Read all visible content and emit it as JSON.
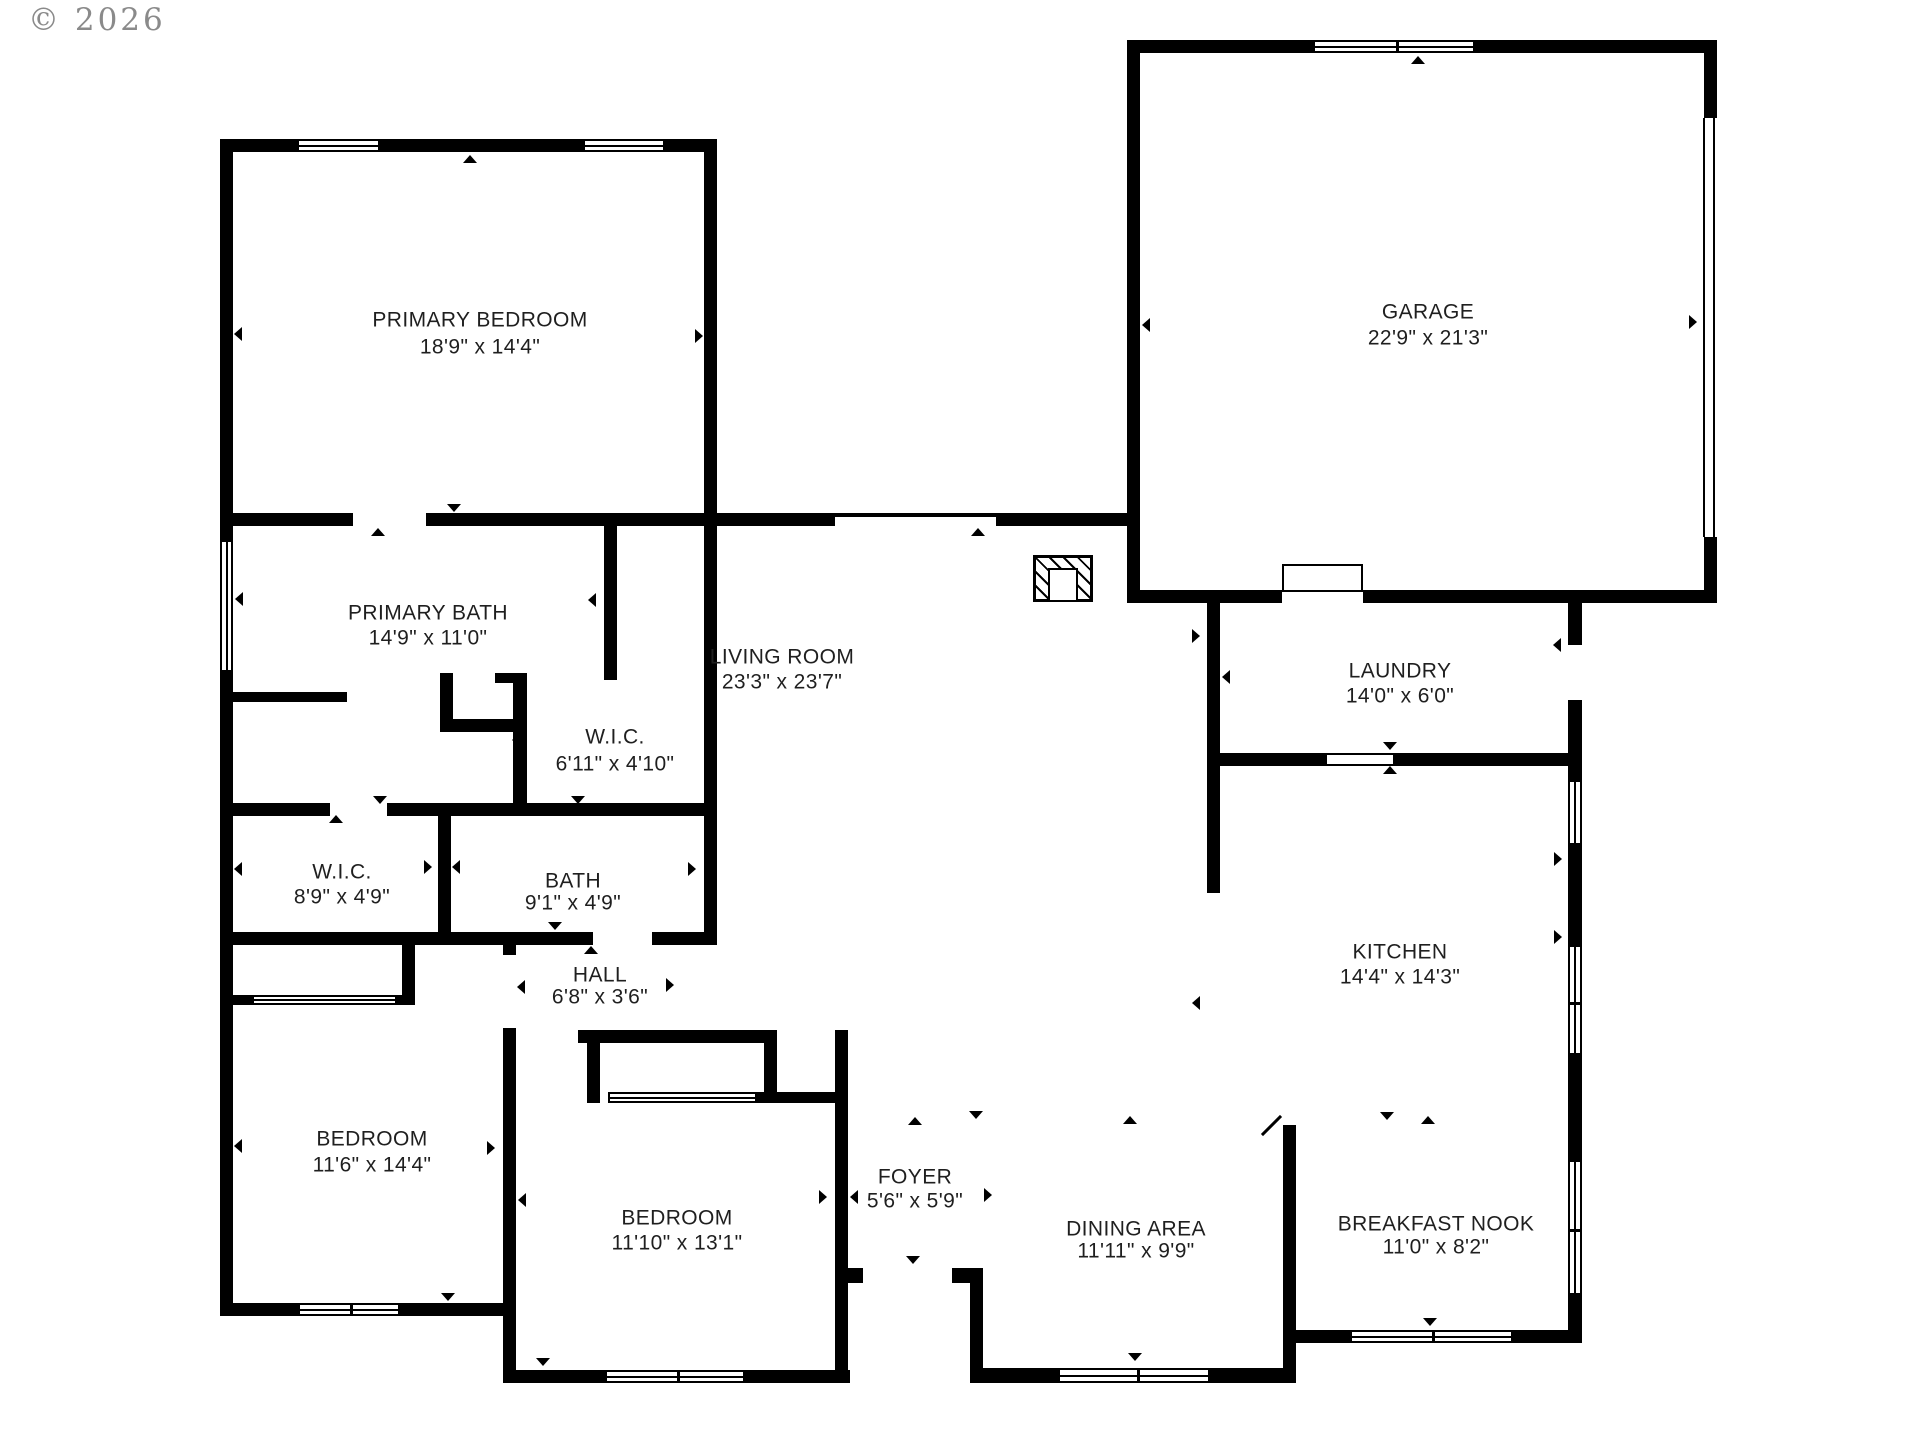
{
  "watermark": {
    "text": "© 2026"
  },
  "canvas": {
    "width": 1920,
    "height": 1440,
    "background": "#ffffff",
    "wall_color": "#000000",
    "label_color": "#1f1f1f",
    "watermark_color": "#8a8a8a"
  },
  "rooms": [
    {
      "name": "PRIMARY BEDROOM",
      "dims": "18'9\" x 14'4\"",
      "cx": 480,
      "y1": 320,
      "y2": 347
    },
    {
      "name": "GARAGE",
      "dims": "22'9\" x 21'3\"",
      "cx": 1428,
      "y1": 312,
      "y2": 338
    },
    {
      "name": "PRIMARY BATH",
      "dims": "14'9\" x 11'0\"",
      "cx": 428,
      "y1": 613,
      "y2": 638
    },
    {
      "name": "W.I.C.",
      "dims": "6'11\" x 4'10\"",
      "cx": 615,
      "y1": 737,
      "y2": 764
    },
    {
      "name": "W.I.C.",
      "dims": "8'9\" x 4'9\"",
      "cx": 342,
      "y1": 872,
      "y2": 897
    },
    {
      "name": "BATH",
      "dims": "9'1\" x 4'9\"",
      "cx": 573,
      "y1": 881,
      "y2": 903
    },
    {
      "name": "LAUNDRY",
      "dims": "14'0\" x 6'0\"",
      "cx": 1400,
      "y1": 671,
      "y2": 696
    },
    {
      "name": "LIVING ROOM",
      "dims": "23'3\" x 23'7\"",
      "cx": 782,
      "y1": 657,
      "y2": 682
    },
    {
      "name": "KITCHEN",
      "dims": "14'4\" x 14'3\"",
      "cx": 1400,
      "y1": 952,
      "y2": 977
    },
    {
      "name": "HALL",
      "dims": "6'8\" x 3'6\"",
      "cx": 600,
      "y1": 975,
      "y2": 997
    },
    {
      "name": "BEDROOM",
      "dims": "11'6\" x 14'4\"",
      "cx": 372,
      "y1": 1139,
      "y2": 1165
    },
    {
      "name": "BEDROOM",
      "dims": "11'10\" x 13'1\"",
      "cx": 677,
      "y1": 1218,
      "y2": 1243
    },
    {
      "name": "FOYER",
      "dims": "5'6\" x 5'9\"",
      "cx": 915,
      "y1": 1177,
      "y2": 1201
    },
    {
      "name": "DINING AREA",
      "dims": "11'11\" x 9'9\"",
      "cx": 1136,
      "y1": 1229,
      "y2": 1251
    },
    {
      "name": "BREAKFAST NOOK",
      "dims": "11'0\" x 8'2\"",
      "cx": 1436,
      "y1": 1224,
      "y2": 1247
    }
  ],
  "walls": [
    [
      220,
      139,
      497,
      13
    ],
    [
      220,
      139,
      13,
      1177
    ],
    [
      704,
      139,
      13,
      804
    ],
    [
      220,
      513,
      497,
      13
    ],
    [
      717,
      513,
      423,
      13
    ],
    [
      1127,
      40,
      13,
      563
    ],
    [
      1127,
      40,
      590,
      13
    ],
    [
      1704,
      40,
      13,
      78
    ],
    [
      1704,
      537,
      13,
      66
    ],
    [
      1127,
      590,
      590,
      13
    ],
    [
      1568,
      590,
      14,
      753
    ],
    [
      1207,
      603,
      13,
      290
    ],
    [
      1207,
      753,
      361,
      13
    ],
    [
      1283,
      1125,
      13,
      258
    ],
    [
      1296,
      1330,
      286,
      13
    ],
    [
      983,
      1368,
      313,
      15
    ],
    [
      835,
      1030,
      13,
      353
    ],
    [
      835,
      1268,
      28,
      15
    ],
    [
      952,
      1268,
      31,
      15
    ],
    [
      970,
      1268,
      13,
      115
    ],
    [
      513,
      1370,
      337,
      13
    ],
    [
      220,
      1303,
      296,
      13
    ],
    [
      503,
      943,
      13,
      440
    ],
    [
      220,
      803,
      497,
      13
    ],
    [
      438,
      813,
      13,
      119
    ],
    [
      220,
      932,
      497,
      13
    ],
    [
      402,
      943,
      13,
      52
    ],
    [
      233,
      995,
      182,
      10
    ],
    [
      233,
      692,
      114,
      10
    ],
    [
      604,
      526,
      13,
      154
    ],
    [
      440,
      673,
      13,
      59
    ],
    [
      440,
      719,
      87,
      13
    ],
    [
      513,
      673,
      14,
      140
    ],
    [
      495,
      673,
      32,
      10
    ],
    [
      578,
      1030,
      199,
      13
    ],
    [
      587,
      1043,
      13,
      60
    ],
    [
      764,
      1043,
      13,
      49
    ],
    [
      757,
      1092,
      80,
      11
    ]
  ],
  "door_gaps": [
    [
      353,
      513,
      73,
      13
    ],
    [
      1282,
      590,
      81,
      13
    ],
    [
      330,
      803,
      57,
      13
    ],
    [
      593,
      932,
      59,
      13
    ],
    [
      503,
      955,
      13,
      73
    ],
    [
      1568,
      645,
      14,
      55
    ],
    [
      863,
      1268,
      89,
      15
    ]
  ],
  "windows": [
    {
      "x": 297,
      "y": 139,
      "w": 83,
      "h": 13,
      "o": "h",
      "mull": []
    },
    {
      "x": 583,
      "y": 139,
      "w": 82,
      "h": 13,
      "o": "h",
      "mull": []
    },
    {
      "x": 1313,
      "y": 40,
      "w": 162,
      "h": 13,
      "o": "h",
      "mull": [
        81
      ]
    },
    {
      "x": 220,
      "y": 540,
      "w": 13,
      "h": 132,
      "o": "v",
      "mull": []
    },
    {
      "x": 1568,
      "y": 780,
      "w": 14,
      "h": 65,
      "o": "v",
      "mull": []
    },
    {
      "x": 1568,
      "y": 945,
      "w": 14,
      "h": 110,
      "o": "v",
      "mull": [
        55
      ]
    },
    {
      "x": 1568,
      "y": 1160,
      "w": 14,
      "h": 135,
      "o": "v",
      "mull": [
        67
      ]
    },
    {
      "x": 1350,
      "y": 1330,
      "w": 163,
      "h": 13,
      "o": "h",
      "mull": [
        80
      ]
    },
    {
      "x": 1058,
      "y": 1368,
      "w": 152,
      "h": 15,
      "o": "h",
      "mull": [
        77
      ]
    },
    {
      "x": 605,
      "y": 1370,
      "w": 140,
      "h": 13,
      "o": "h",
      "mull": [
        70
      ]
    },
    {
      "x": 298,
      "y": 1303,
      "w": 102,
      "h": 13,
      "o": "h",
      "mull": [
        50
      ]
    },
    {
      "x": 252,
      "y": 995,
      "w": 145,
      "h": 10,
      "o": "h",
      "mull": []
    },
    {
      "x": 608,
      "y": 1092,
      "w": 149,
      "h": 11,
      "o": "h",
      "mull": []
    },
    {
      "x": 1327,
      "y": 753,
      "w": 66,
      "h": 13,
      "o": "cased",
      "mull": []
    },
    {
      "x": 835,
      "y": 514,
      "w": 161,
      "h": 12,
      "o": "thin-top",
      "mull": []
    },
    {
      "x": 1703,
      "y": 118,
      "w": 12,
      "h": 419,
      "o": "gdoor",
      "mull": []
    }
  ],
  "markers": [
    {
      "x": 371,
      "y": 528,
      "d": "up"
    },
    {
      "x": 447,
      "y": 504,
      "d": "down"
    },
    {
      "x": 971,
      "y": 528,
      "d": "up"
    },
    {
      "x": 1411,
      "y": 56,
      "d": "up"
    },
    {
      "x": 1689,
      "y": 315,
      "d": "right"
    },
    {
      "x": 234,
      "y": 327,
      "d": "left"
    },
    {
      "x": 695,
      "y": 329,
      "d": "right"
    },
    {
      "x": 463,
      "y": 155,
      "d": "up"
    },
    {
      "x": 1142,
      "y": 318,
      "d": "left"
    },
    {
      "x": 235,
      "y": 592,
      "d": "left"
    },
    {
      "x": 588,
      "y": 593,
      "d": "left"
    },
    {
      "x": 512,
      "y": 733,
      "d": "left"
    },
    {
      "x": 329,
      "y": 815,
      "d": "up"
    },
    {
      "x": 373,
      "y": 796,
      "d": "down"
    },
    {
      "x": 571,
      "y": 796,
      "d": "down"
    },
    {
      "x": 548,
      "y": 922,
      "d": "down"
    },
    {
      "x": 584,
      "y": 946,
      "d": "up"
    },
    {
      "x": 234,
      "y": 862,
      "d": "left"
    },
    {
      "x": 424,
      "y": 860,
      "d": "right"
    },
    {
      "x": 452,
      "y": 860,
      "d": "left"
    },
    {
      "x": 688,
      "y": 862,
      "d": "right"
    },
    {
      "x": 517,
      "y": 980,
      "d": "left"
    },
    {
      "x": 666,
      "y": 978,
      "d": "right"
    },
    {
      "x": 1192,
      "y": 996,
      "d": "left"
    },
    {
      "x": 1192,
      "y": 629,
      "d": "right"
    },
    {
      "x": 1222,
      "y": 670,
      "d": "left"
    },
    {
      "x": 1553,
      "y": 638,
      "d": "left"
    },
    {
      "x": 1554,
      "y": 852,
      "d": "right"
    },
    {
      "x": 1554,
      "y": 930,
      "d": "right"
    },
    {
      "x": 487,
      "y": 1141,
      "d": "right"
    },
    {
      "x": 518,
      "y": 1193,
      "d": "left"
    },
    {
      "x": 234,
      "y": 1139,
      "d": "left"
    },
    {
      "x": 441,
      "y": 1293,
      "d": "down"
    },
    {
      "x": 536,
      "y": 1358,
      "d": "down"
    },
    {
      "x": 819,
      "y": 1190,
      "d": "right"
    },
    {
      "x": 850,
      "y": 1190,
      "d": "left"
    },
    {
      "x": 984,
      "y": 1188,
      "d": "right"
    },
    {
      "x": 906,
      "y": 1256,
      "d": "down"
    },
    {
      "x": 908,
      "y": 1117,
      "d": "up"
    },
    {
      "x": 969,
      "y": 1111,
      "d": "down"
    },
    {
      "x": 1123,
      "y": 1116,
      "d": "up"
    },
    {
      "x": 1380,
      "y": 1112,
      "d": "down"
    },
    {
      "x": 1421,
      "y": 1116,
      "d": "up"
    },
    {
      "x": 1423,
      "y": 1318,
      "d": "down"
    },
    {
      "x": 1128,
      "y": 1353,
      "d": "down"
    },
    {
      "x": 1383,
      "y": 742,
      "d": "down"
    },
    {
      "x": 1383,
      "y": 766,
      "d": "up"
    },
    {
      "x": 1312,
      "y": 568,
      "d": "down big"
    }
  ],
  "leaf": {
    "x": 1270,
    "y": 1112,
    "w": 3,
    "len": 27,
    "rot": 45
  },
  "fireplace": {
    "x": 1033,
    "y": 555,
    "w": 60,
    "h": 47,
    "inner": {
      "x": 15,
      "y": 13,
      "w": 30,
      "h": 34
    }
  },
  "garage_step": {
    "x": 1282,
    "y": 564,
    "w": 81,
    "h": 28
  }
}
